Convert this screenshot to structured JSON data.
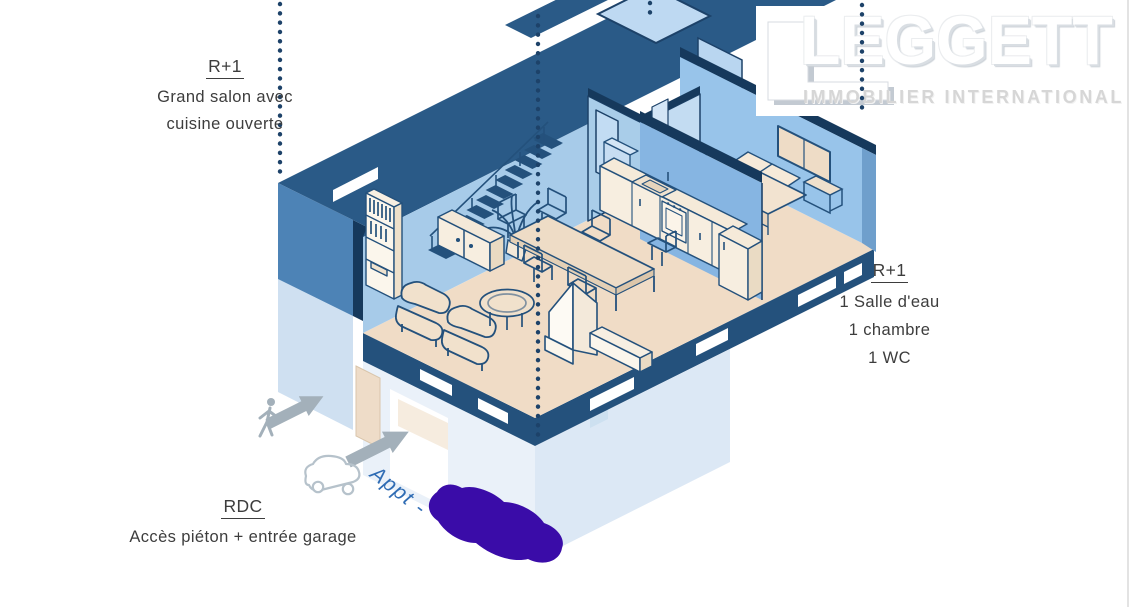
{
  "page": {
    "background": "#ffffff"
  },
  "logo": {
    "brand": "LEGGETT",
    "tagline": "IMMOBILIER INTERNATIONAL",
    "mark": "white-L-block-icon",
    "text_color": "#ffffff",
    "shadow_color": "#c3cad2"
  },
  "annotations": {
    "upper_floor_left": {
      "title": "R+1",
      "lines": [
        "Grand salon avec",
        "cuisine ouverte"
      ]
    },
    "upper_floor_right": {
      "title": "R+1",
      "lines": [
        "1 Salle d'eau",
        "1 chambre",
        "1 WC"
      ]
    },
    "ground_floor": {
      "title": "RDC",
      "lines": [
        "Accès piéton + entrée garage"
      ]
    },
    "handwritten_note": {
      "text": "Appt -",
      "color": "#2f6cb4"
    }
  },
  "floorplan": {
    "view": "isometric cutaway apartment drawing",
    "levels": [
      "RDC",
      "R+1"
    ],
    "rooms_r1": [
      "Grand salon avec cuisine ouverte",
      "1 Salle d'eau",
      "1 chambre",
      "1 WC"
    ],
    "features_rdc": [
      "Accès piéton",
      "Entrée garage"
    ],
    "furniture": [
      "staircase",
      "bookshelf",
      "sideboard",
      "plant",
      "dining table",
      "chairs",
      "kitchen counter",
      "oven",
      "sink",
      "fireplace",
      "bench",
      "armchairs",
      "coffee table",
      "bed",
      "pillows",
      "nightstand"
    ],
    "colors": {
      "cut_wall_dark": "#24517c",
      "cut_band": "#2a5a87",
      "wall_medium": "#4d83b6",
      "wall_light": "#a7cbe9",
      "partition": "#86b5e2",
      "floor_beige": "#f0dcc6",
      "ground_floor_pale": "#dce8f5",
      "outline_navy": "#24517c"
    }
  },
  "icons": {
    "pedestrian": "walking-person-icon",
    "car": "car-outline-icon",
    "entry_arrows": "solid-arrow-icon",
    "arrow_color": "#a3b0ba",
    "scribble_color": "#3a0ca8",
    "section_line_color": "#1d4269"
  }
}
